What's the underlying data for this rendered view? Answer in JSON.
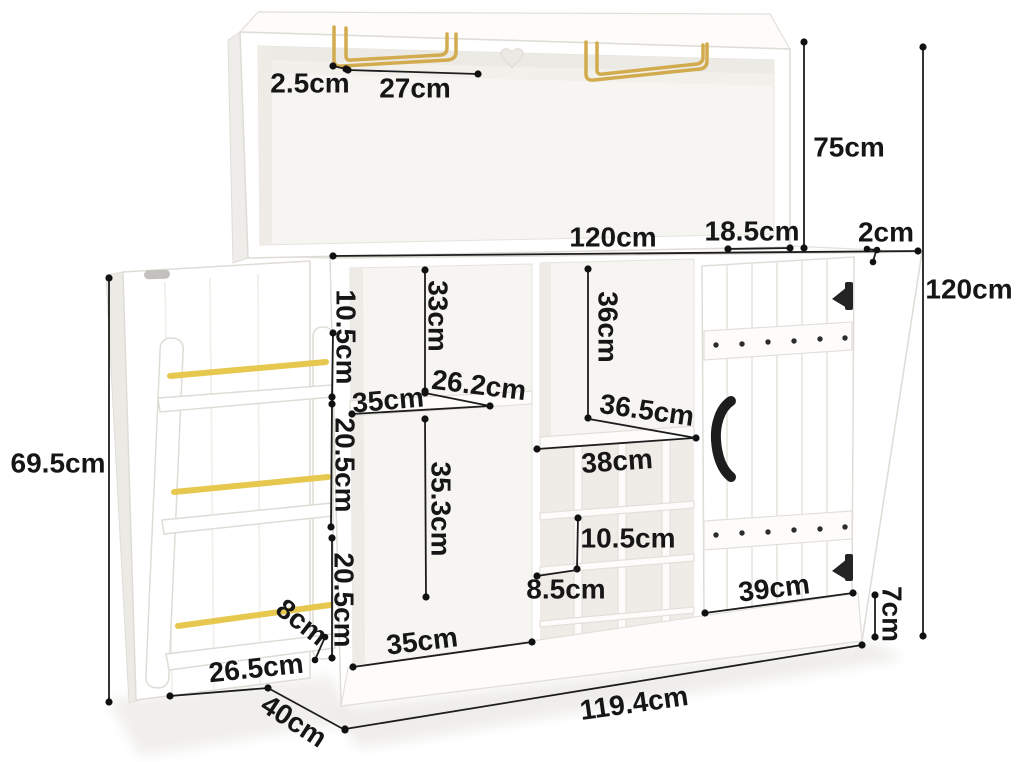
{
  "title": "Bar cabinet with hutch - dimension diagram",
  "unit": "cm",
  "colors": {
    "accent_gold": "#d3ab4f",
    "annotation_ink": "#161616",
    "furniture": "#ffffff"
  },
  "labels": {
    "glass_rack_offset": "2.5cm",
    "glass_rack_length": "27cm",
    "hutch_height": "75cm",
    "cabinet_width": "120cm",
    "top_depth": "18.5cm",
    "top_thickness": "2cm",
    "total_height": "120cm",
    "door_rack_height": "69.5cm",
    "door_rack_top_section": "10.5cm",
    "door_rack_mid_section": "20.5cm",
    "door_rack_bottom_section": "20.5cm",
    "upper_left_compartment_height": "33cm",
    "shelf_depth": "26.2cm",
    "upper_shelf_width": "35cm",
    "center_compartment_height": "36cm",
    "center_shelf_depth": "36.5cm",
    "wine_rack_width": "38cm",
    "wine_slot_height": "10.5cm",
    "wine_slot_width": "8.5cm",
    "lower_left_compartment_height": "35.3cm",
    "lower_left_compartment_width": "35cm",
    "door_rack_rail_height": "8cm",
    "door_rack_width": "26.5cm",
    "cabinet_depth": "40cm",
    "door_base_width": "39cm",
    "base_height": "7cm",
    "base_width": "119.4cm"
  }
}
